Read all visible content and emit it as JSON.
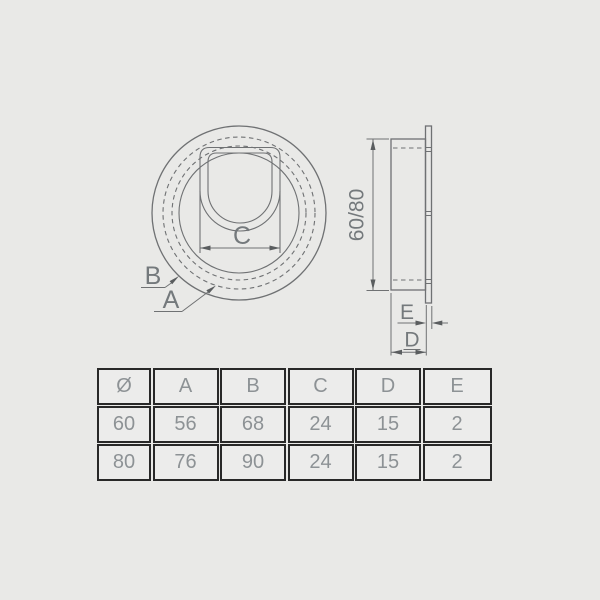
{
  "page": {
    "background": "#e9e9e7"
  },
  "colors": {
    "page_bg": "#e9e9e7",
    "line": "#6f7173",
    "label": "#74797c",
    "arrow": "#5a5d5f",
    "table_border": "#282828",
    "table_text": "#8d9295",
    "cell_bg": "#ececeb"
  },
  "drawing": {
    "front_view": {
      "label_b": "B",
      "label_a": "A",
      "dim_c_label": "C"
    },
    "side_view": {
      "dim_height_label": "60/80",
      "dim_e_label": "E",
      "dim_d_label": "D"
    }
  },
  "table": {
    "headers": [
      "Ø",
      "A",
      "B",
      "C",
      "D",
      "E"
    ],
    "rows": [
      [
        "60",
        "56",
        "68",
        "24",
        "15",
        "2"
      ],
      [
        "80",
        "76",
        "90",
        "24",
        "15",
        "2"
      ]
    ]
  }
}
